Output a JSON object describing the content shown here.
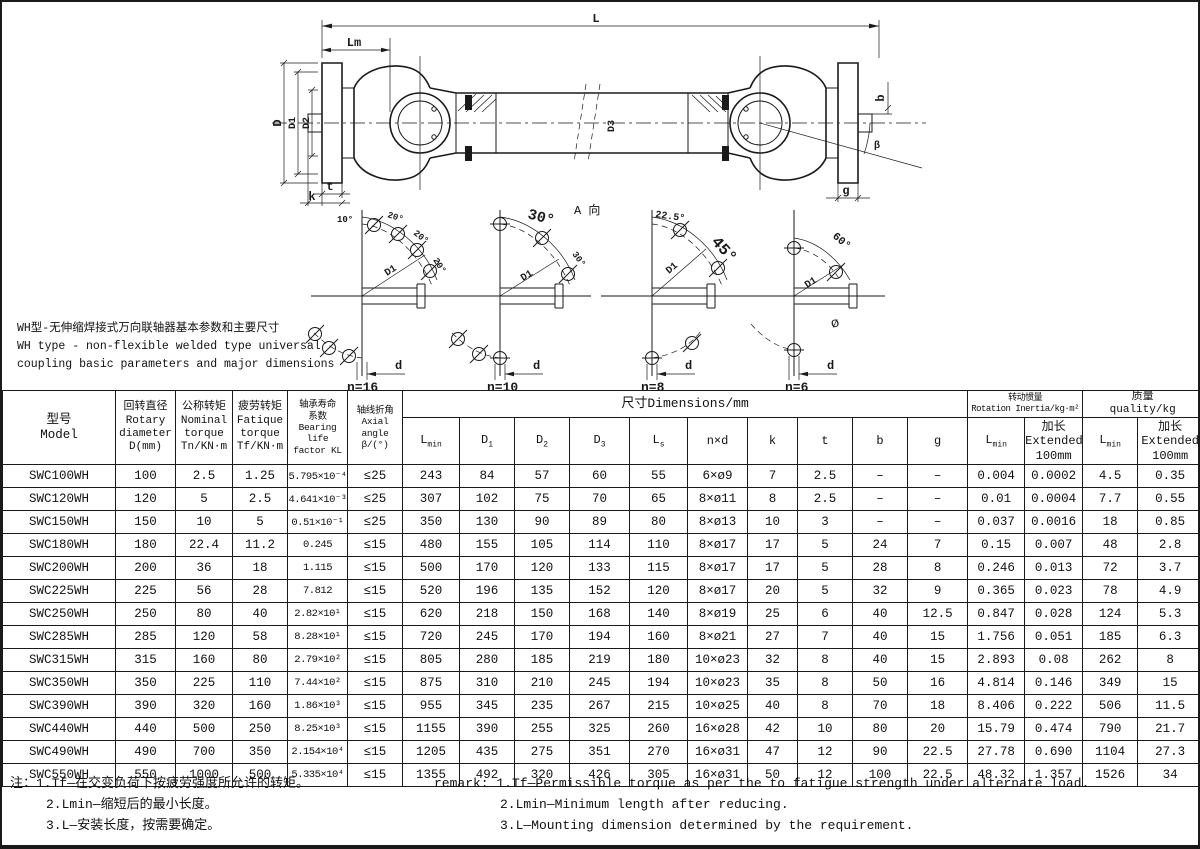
{
  "description": {
    "zh": "WH型-无伸缩焊接式万向联轴器基本参数和主要尺寸",
    "en1": "WH type - non-flexible welded type universal",
    "en2": "coupling basic parameters and major dimensions"
  },
  "drawing": {
    "dim_labels": {
      "L": "L",
      "Lm": "Lm",
      "D": "D",
      "D1": "D1",
      "D2": "D2",
      "D3": "D3",
      "b": "b",
      "g": "g",
      "t": "t",
      "k": "k",
      "beta": "β",
      "view": "A 向"
    },
    "flanges": [
      {
        "n": "n=16",
        "angles": [
          "10°",
          "20°",
          "20°",
          "20°"
        ],
        "radius": "D1",
        "d": "d"
      },
      {
        "n": "n=10",
        "angles": [
          "30°",
          "30°"
        ],
        "radius": "D1",
        "d": "d"
      },
      {
        "n": "n=8",
        "angles": [
          "22.5°",
          "45°"
        ],
        "radius": "D1",
        "d": "d"
      },
      {
        "n": "n=6",
        "angles": [
          "60°"
        ],
        "radius": "D1",
        "d": "d",
        "phi": "ø"
      }
    ]
  },
  "table": {
    "headers": {
      "model": "型号\nModel",
      "rotary": "回转直径\nRotary\ndiameter\nD(mm)",
      "nominal": "公称转矩\nNominal\ntorque\nTn/KN·m",
      "fatigue": "疲劳转矩\nFatique\ntorque\nTf/KN·m",
      "bearing": "轴承寿命\n系数\nBearing life\nfactor KL",
      "axial": "轴线折角\nAxial angle\nβ/(°)",
      "dims_group": "尺寸Dimensions/mm",
      "inertia_group": "转动惯量\nRotation Inertia/kg·m²",
      "quality_group": "质量\nquality/kg",
      "dim_cols": [
        {
          "base": "L",
          "sub": "min"
        },
        {
          "base": "D",
          "sub": "1"
        },
        {
          "base": "D",
          "sub": "2"
        },
        {
          "base": "D",
          "sub": "3"
        },
        {
          "base": "L",
          "sub": "s"
        },
        {
          "base": "n×d",
          "sub": ""
        },
        {
          "base": "k",
          "sub": ""
        },
        {
          "base": "t",
          "sub": ""
        },
        {
          "base": "b",
          "sub": ""
        },
        {
          "base": "g",
          "sub": ""
        }
      ],
      "lmin": {
        "base": "L",
        "sub": "min"
      },
      "extended": "加长\nExtended\n100mm"
    },
    "rows": [
      [
        "SWC100WH",
        "100",
        "2.5",
        "1.25",
        "5.795×10⁻⁴",
        "≤25",
        "243",
        "84",
        "57",
        "60",
        "55",
        "6×ø9",
        "7",
        "2.5",
        "–",
        "–",
        "0.004",
        "0.0002",
        "4.5",
        "0.35"
      ],
      [
        "SWC120WH",
        "120",
        "5",
        "2.5",
        "4.641×10⁻³",
        "≤25",
        "307",
        "102",
        "75",
        "70",
        "65",
        "8×ø11",
        "8",
        "2.5",
        "–",
        "–",
        "0.01",
        "0.0004",
        "7.7",
        "0.55"
      ],
      [
        "SWC150WH",
        "150",
        "10",
        "5",
        "0.51×10⁻¹",
        "≤25",
        "350",
        "130",
        "90",
        "89",
        "80",
        "8×ø13",
        "10",
        "3",
        "–",
        "–",
        "0.037",
        "0.0016",
        "18",
        "0.85"
      ],
      [
        "SWC180WH",
        "180",
        "22.4",
        "11.2",
        "0.245",
        "≤15",
        "480",
        "155",
        "105",
        "114",
        "110",
        "8×ø17",
        "17",
        "5",
        "24",
        "7",
        "0.15",
        "0.007",
        "48",
        "2.8"
      ],
      [
        "SWC200WH",
        "200",
        "36",
        "18",
        "1.115",
        "≤15",
        "500",
        "170",
        "120",
        "133",
        "115",
        "8×ø17",
        "17",
        "5",
        "28",
        "8",
        "0.246",
        "0.013",
        "72",
        "3.7"
      ],
      [
        "SWC225WH",
        "225",
        "56",
        "28",
        "7.812",
        "≤15",
        "520",
        "196",
        "135",
        "152",
        "120",
        "8×ø17",
        "20",
        "5",
        "32",
        "9",
        "0.365",
        "0.023",
        "78",
        "4.9"
      ],
      [
        "SWC250WH",
        "250",
        "80",
        "40",
        "2.82×10¹",
        "≤15",
        "620",
        "218",
        "150",
        "168",
        "140",
        "8×ø19",
        "25",
        "6",
        "40",
        "12.5",
        "0.847",
        "0.028",
        "124",
        "5.3"
      ],
      [
        "SWC285WH",
        "285",
        "120",
        "58",
        "8.28×10¹",
        "≤15",
        "720",
        "245",
        "170",
        "194",
        "160",
        "8×ø21",
        "27",
        "7",
        "40",
        "15",
        "1.756",
        "0.051",
        "185",
        "6.3"
      ],
      [
        "SWC315WH",
        "315",
        "160",
        "80",
        "2.79×10²",
        "≤15",
        "805",
        "280",
        "185",
        "219",
        "180",
        "10×ø23",
        "32",
        "8",
        "40",
        "15",
        "2.893",
        "0.08",
        "262",
        "8"
      ],
      [
        "SWC350WH",
        "350",
        "225",
        "110",
        "7.44×10²",
        "≤15",
        "875",
        "310",
        "210",
        "245",
        "194",
        "10×ø23",
        "35",
        "8",
        "50",
        "16",
        "4.814",
        "0.146",
        "349",
        "15"
      ],
      [
        "SWC390WH",
        "390",
        "320",
        "160",
        "1.86×10³",
        "≤15",
        "955",
        "345",
        "235",
        "267",
        "215",
        "10×ø25",
        "40",
        "8",
        "70",
        "18",
        "8.406",
        "0.222",
        "506",
        "11.5"
      ],
      [
        "SWC440WH",
        "440",
        "500",
        "250",
        "8.25×10³",
        "≤15",
        "1155",
        "390",
        "255",
        "325",
        "260",
        "16×ø28",
        "42",
        "10",
        "80",
        "20",
        "15.79",
        "0.474",
        "790",
        "21.7"
      ],
      [
        "SWC490WH",
        "490",
        "700",
        "350",
        "2.154×10⁴",
        "≤15",
        "1205",
        "435",
        "275",
        "351",
        "270",
        "16×ø31",
        "47",
        "12",
        "90",
        "22.5",
        "27.78",
        "0.690",
        "1104",
        "27.3"
      ],
      [
        "SWC550WH",
        "550",
        "1000",
        "500",
        "5.335×10⁴",
        "≤15",
        "1355",
        "492",
        "320",
        "426",
        "305",
        "16×ø31",
        "50",
        "12",
        "100",
        "22.5",
        "48.32",
        "1.357",
        "1526",
        "34"
      ]
    ]
  },
  "remarks": {
    "zh": [
      "注：1.Tf—在交变负荷下按疲劳强度所允许的转矩。",
      "2.Lmin—缩短后的最小长度。",
      "3.L—安装长度，按需要确定。"
    ],
    "en": [
      "remark: 1.Tf—Permissible torque as per the to fatigue strength under alternate load.",
      "2.Lmin—Minimum length after reducing.",
      "3.L—Mounting dimension determined by the requirement."
    ]
  }
}
